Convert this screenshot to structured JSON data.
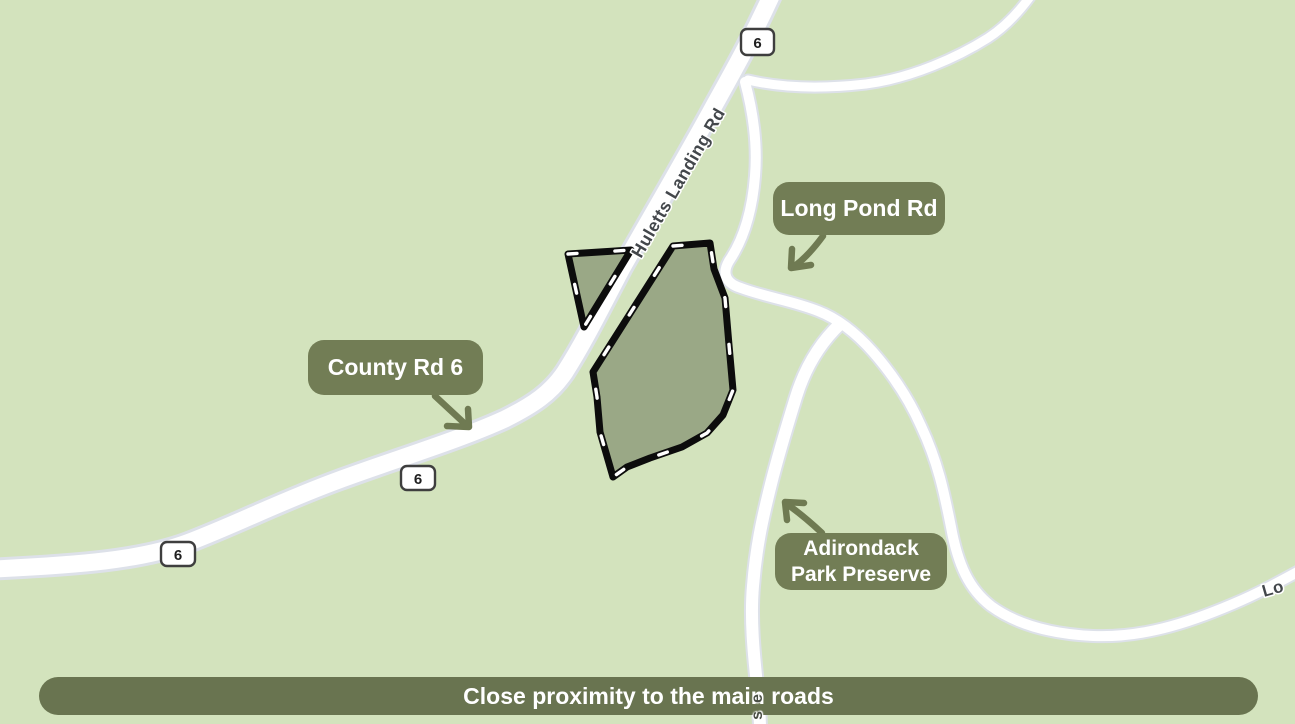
{
  "map": {
    "banner": {
      "text": "Close proximity to the main roads"
    },
    "callouts": {
      "long_pond": {
        "label": "Long Pond Rd"
      },
      "county_rd6": {
        "label": "County Rd 6"
      },
      "adirondack": {
        "line1": "Adirondack",
        "line2": "Park Preserve"
      }
    },
    "road_labels": {
      "huletts": "Huletts Landing Rd",
      "long_pond_partial": "Lo",
      "vertical_road_partial": "se"
    },
    "shields": [
      {
        "label": "6"
      },
      {
        "label": "6"
      },
      {
        "label": "6"
      }
    ],
    "colors": {
      "background": "#d3e3bd",
      "road": "#ffffff",
      "road_casing": "#dde1e9",
      "parcel_fill": "#9aa886",
      "parcel_border": "#0c0c0c",
      "callout_pill": "#727d55",
      "banner": "#697450",
      "arrow": "#6f7a52"
    }
  }
}
